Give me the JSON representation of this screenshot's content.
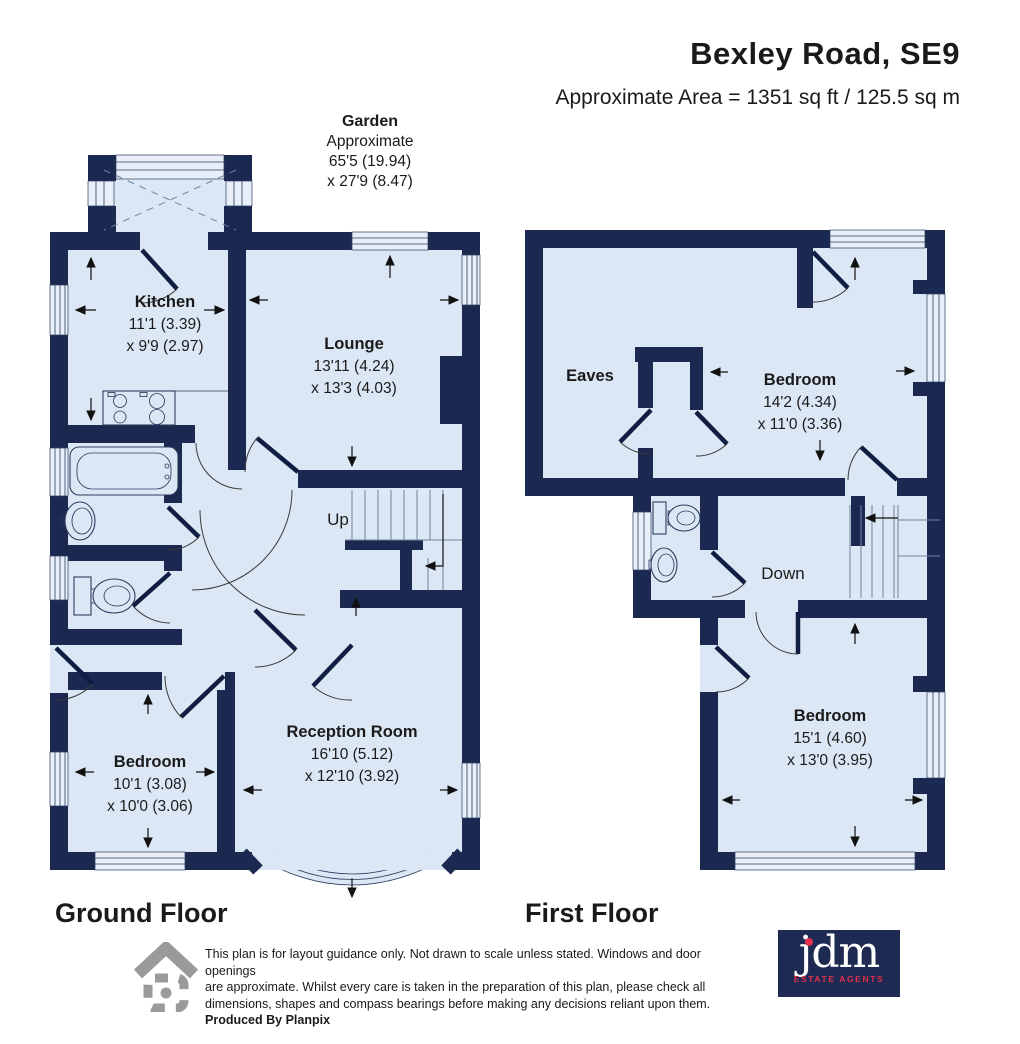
{
  "header": {
    "title": "Bexley Road, SE9",
    "subtitle": "Approximate Area = 1351 sq ft / 125.5 sq m"
  },
  "garden": {
    "name": "Garden",
    "line1": "Approximate",
    "line2": "65'5 (19.94)",
    "line3": "x 27'9 (8.47)"
  },
  "ground_floor": {
    "label": "Ground Floor",
    "rooms": {
      "kitchen": {
        "name": "Kitchen",
        "dim1": "11'1 (3.39)",
        "dim2": "x 9'9 (2.97)"
      },
      "lounge": {
        "name": "Lounge",
        "dim1": "13'11 (4.24)",
        "dim2": "x 13'3 (4.03)"
      },
      "reception": {
        "name": "Reception Room",
        "dim1": "16'10 (5.12)",
        "dim2": "x 12'10 (3.92)"
      },
      "bedroom": {
        "name": "Bedroom",
        "dim1": "10'1 (3.08)",
        "dim2": "x 10'0 (3.06)"
      }
    },
    "stairs_label": "Up"
  },
  "first_floor": {
    "label": "First Floor",
    "rooms": {
      "eaves": {
        "name": "Eaves"
      },
      "bedroom1": {
        "name": "Bedroom",
        "dim1": "14'2 (4.34)",
        "dim2": "x 11'0 (3.36)"
      },
      "bedroom2": {
        "name": "Bedroom",
        "dim1": "15'1 (4.60)",
        "dim2": "x 13'0 (3.95)"
      }
    },
    "stairs_label": "Down"
  },
  "footer": {
    "disclaimer_line1": "This plan is for layout guidance only. Not drawn to scale unless stated. Windows and door openings",
    "disclaimer_line2": "are approximate. Whilst every care is taken in the preparation of this plan, please check all",
    "disclaimer_line3": "dimensions, shapes and compass bearings before making any decisions reliant upon them.",
    "produced_by": "Produced By Planpix",
    "logo": {
      "name": "jdm",
      "tagline": "ESTATE AGENTS"
    }
  },
  "colors": {
    "wall": "#1b2950",
    "room": "#dce7f5",
    "logo_navy": "#1e2a52",
    "logo_red": "#e4304c"
  }
}
